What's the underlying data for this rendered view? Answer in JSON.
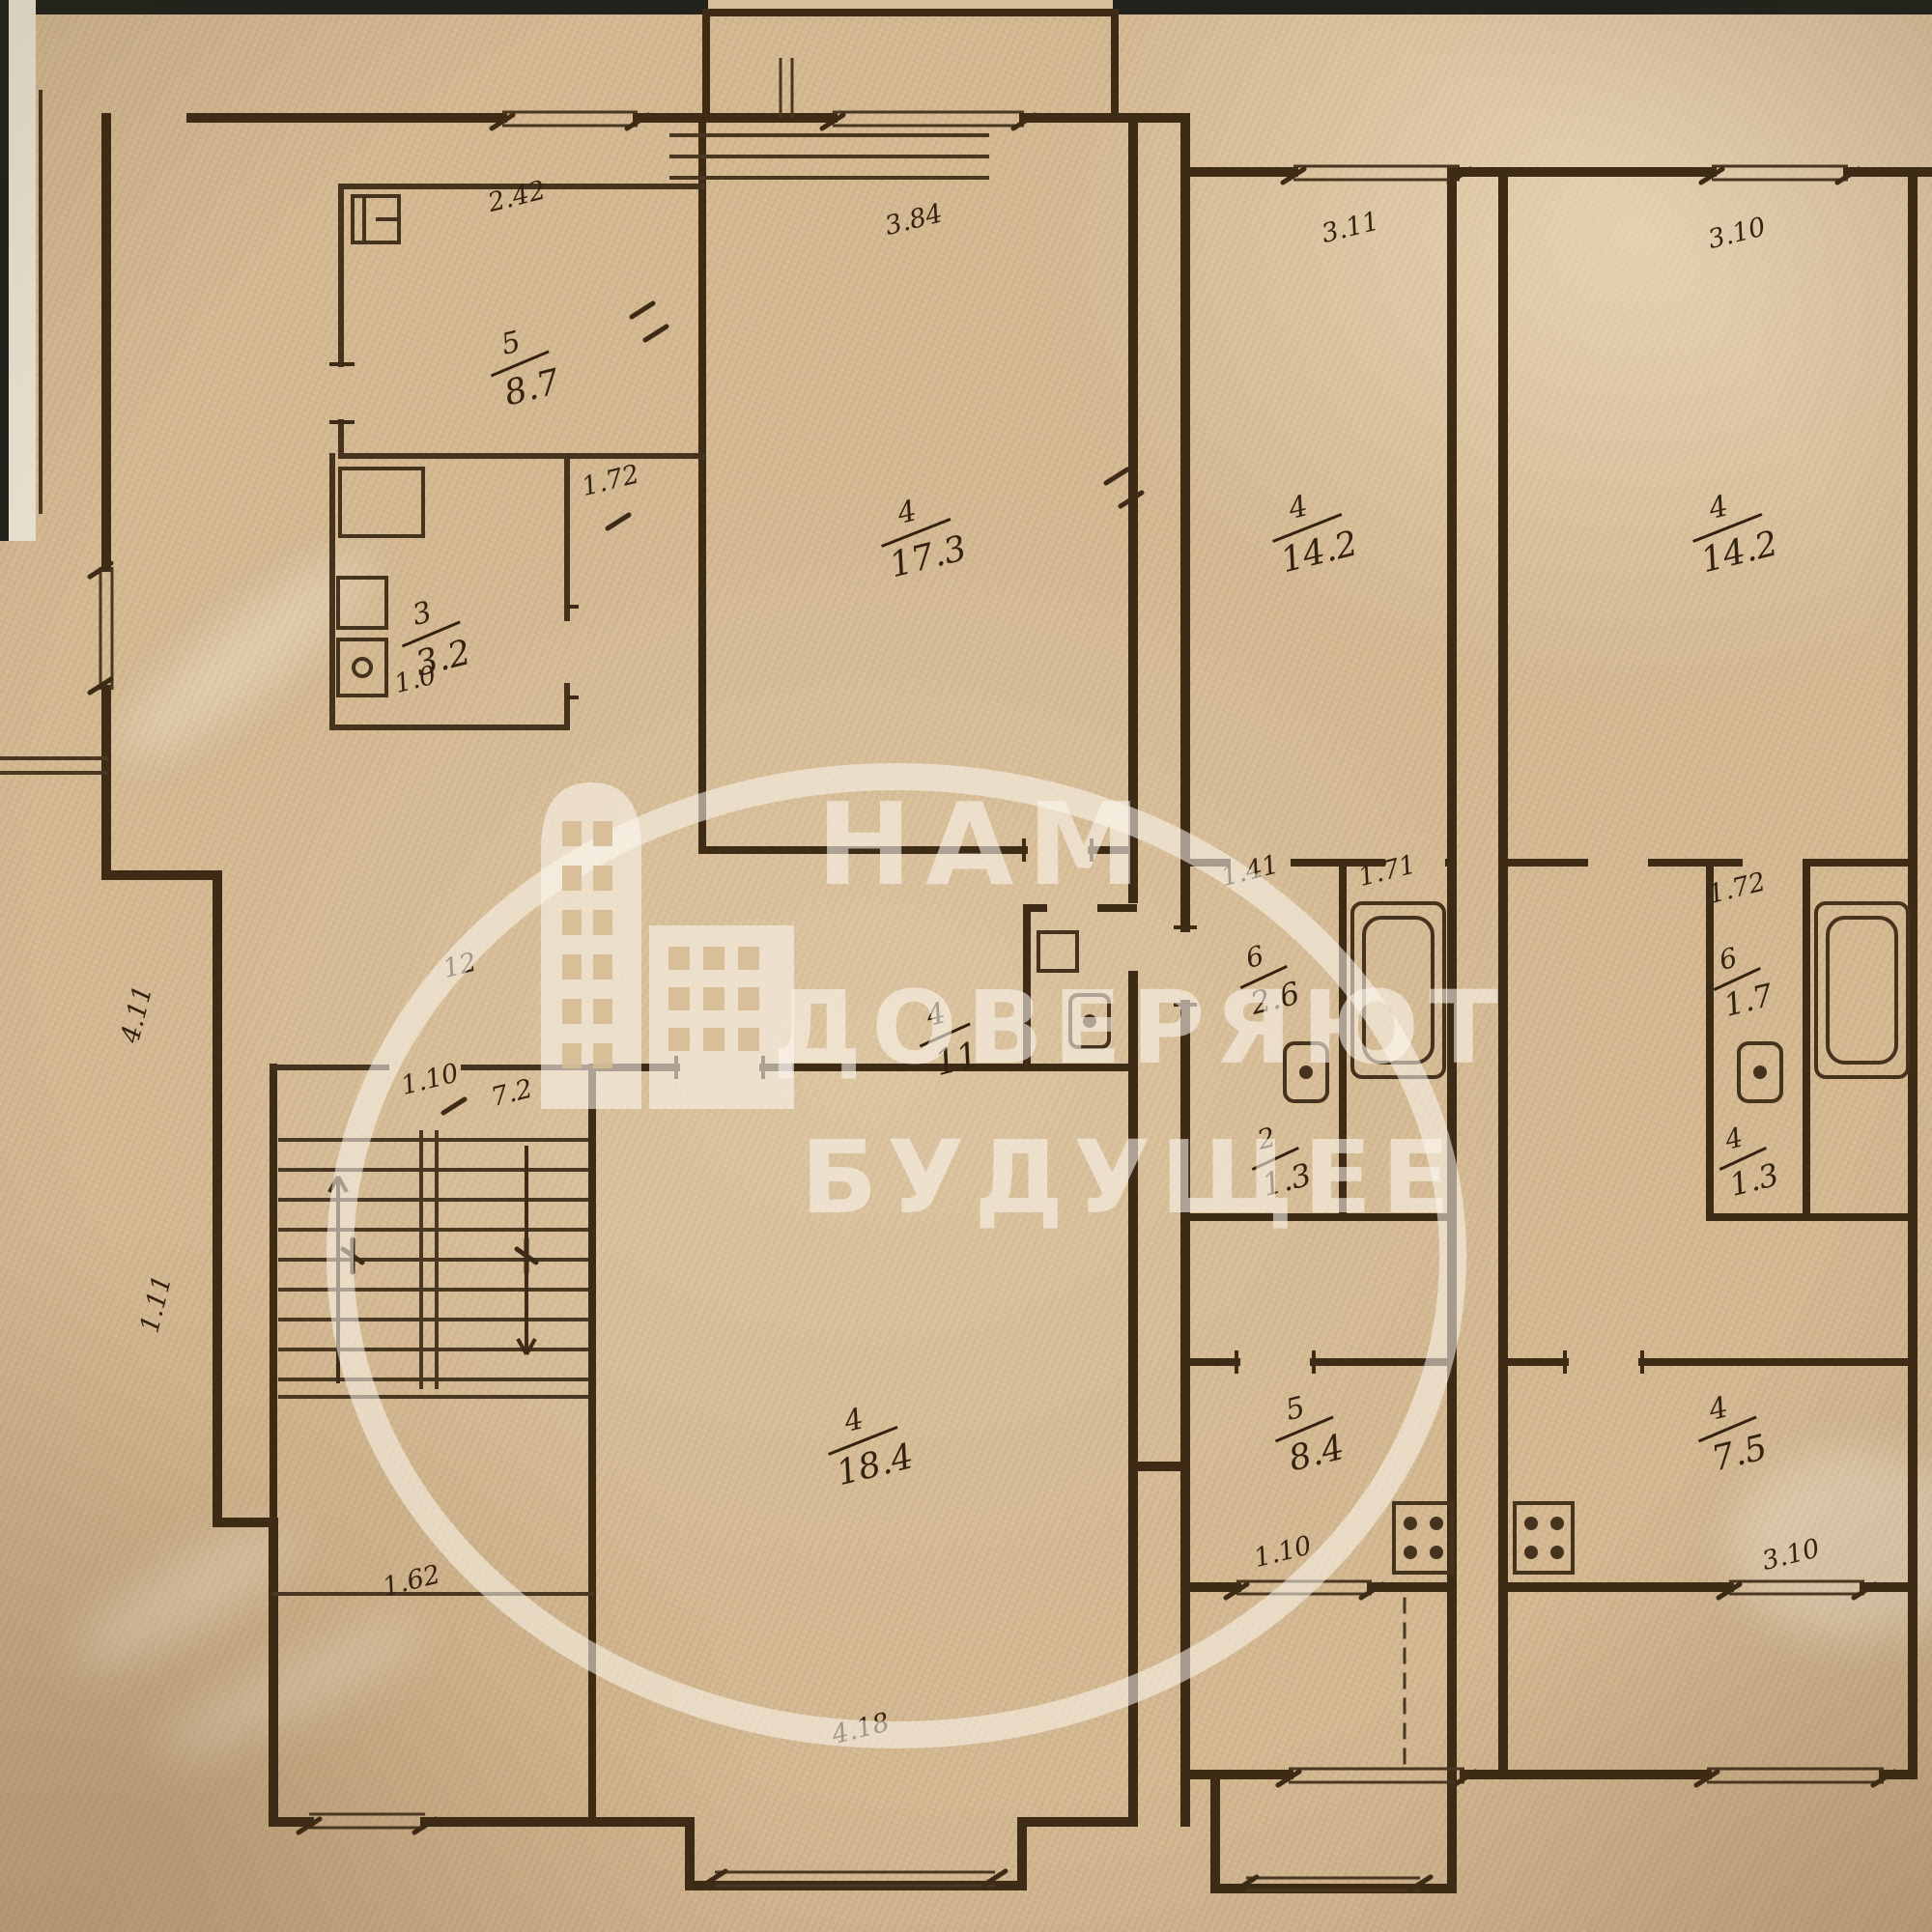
{
  "document": {
    "type": "scanned apartment floor plan (BTI technical plan)",
    "paper_color": "#d5ba93",
    "ink_color": "#3e2b16",
    "watermark_color": "rgba(252,247,238,0.58)"
  },
  "watermark": {
    "line1": "НАМ",
    "line2": "ДОВЕРЯЮТ",
    "line3": "БУДУЩЕЕ",
    "icon": "building-icon"
  },
  "rooms": [
    {
      "num": "5",
      "area": "8.7"
    },
    {
      "num": "3",
      "area": "3.2"
    },
    {
      "num": "4",
      "area": "17.3"
    },
    {
      "num": "4",
      "area": "14.2"
    },
    {
      "num": "4",
      "area": "14.2"
    },
    {
      "num": "4",
      "area": "11"
    },
    {
      "num": "6",
      "area": "2.6"
    },
    {
      "num": "2",
      "area": "1.3"
    },
    {
      "num": "6",
      "area": "1.7"
    },
    {
      "num": "4",
      "area": "1.3"
    },
    {
      "num": "4",
      "area": "18.4"
    },
    {
      "num": "5",
      "area": "8.4"
    },
    {
      "num": "4",
      "area": "7.5"
    }
  ],
  "dims": [
    {
      "text": "2.42"
    },
    {
      "text": "3.84"
    },
    {
      "text": "3.11"
    },
    {
      "text": "3.10"
    },
    {
      "text": "1.72"
    },
    {
      "text": "1.41"
    },
    {
      "text": "1.71"
    },
    {
      "text": "1.72"
    },
    {
      "text": "12"
    },
    {
      "text": "1.10"
    },
    {
      "text": "7.2"
    },
    {
      "text": "1.62"
    },
    {
      "text": "4.18"
    },
    {
      "text": "1.10"
    },
    {
      "text": "3.10"
    },
    {
      "text": "1.11"
    },
    {
      "text": "4.11"
    },
    {
      "text": "1.0"
    }
  ]
}
